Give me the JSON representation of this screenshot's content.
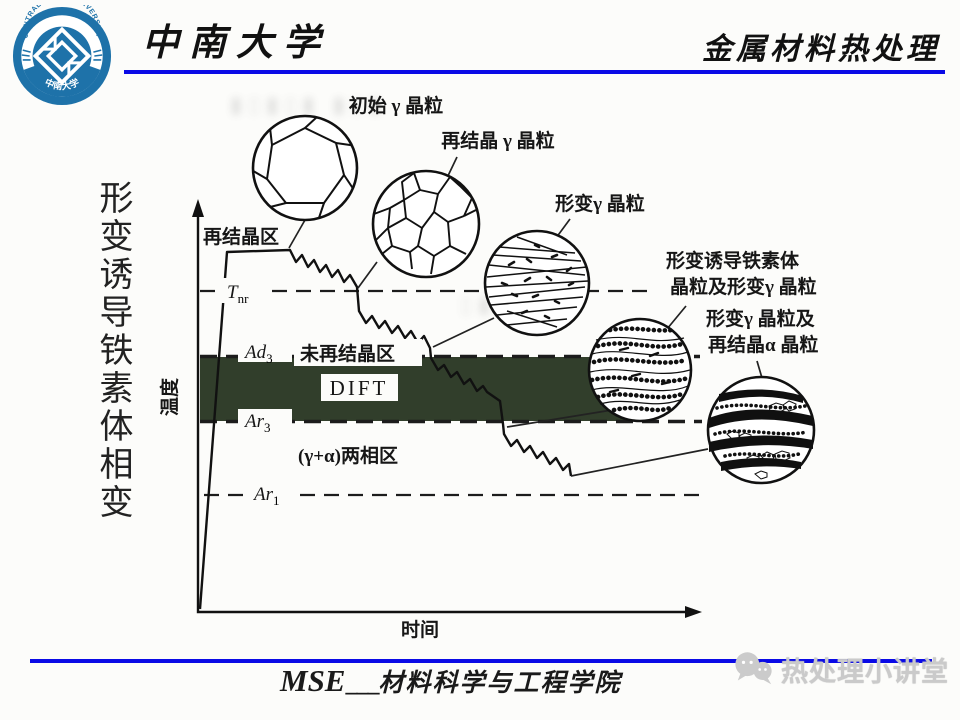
{
  "header": {
    "logo": {
      "arc_text": "CENTRAL SOUTH UNIVERSITY",
      "bottom_text": "中南大学"
    },
    "university": "中南大学",
    "course": "金属材料热处理"
  },
  "side_title": "形变诱导铁素体相变",
  "diagram": {
    "axes": {
      "y_label": "温度",
      "x_label": "时间"
    },
    "regions": {
      "recryst": "再结晶区",
      "non_recryst": "未再结晶区",
      "dift": "DIFT",
      "two_phase": "(γ+α)两相区"
    },
    "iso_lines": {
      "tnr_main": "T",
      "tnr_sub": "nr",
      "ad3_main": "Ad",
      "ad3_sub": "3",
      "ar3_main": "Ar",
      "ar3_sub": "3",
      "ar1_main": "Ar",
      "ar1_sub": "1"
    },
    "micrographs": {
      "initial": "初始 γ 晶粒",
      "recrystallized": "再结晶 γ 晶粒",
      "deformed": "形变γ 晶粒",
      "dift_line1": "形变诱导铁素体",
      "dift_line2": "晶粒及形变γ 晶粒",
      "alpha_line1": "形变γ 晶粒及",
      "alpha_line2": "再结晶α 晶粒"
    }
  },
  "footer": {
    "mse": "MSE",
    "underscores": "___",
    "department": "材料科学与工程学院",
    "watermark": "热处理小讲堂"
  },
  "colors": {
    "rule_blue": "#0a0ae6",
    "band_green": "#2c3926",
    "logo_blue": "#1e72a9",
    "watermark_gray": "#cacaca"
  }
}
